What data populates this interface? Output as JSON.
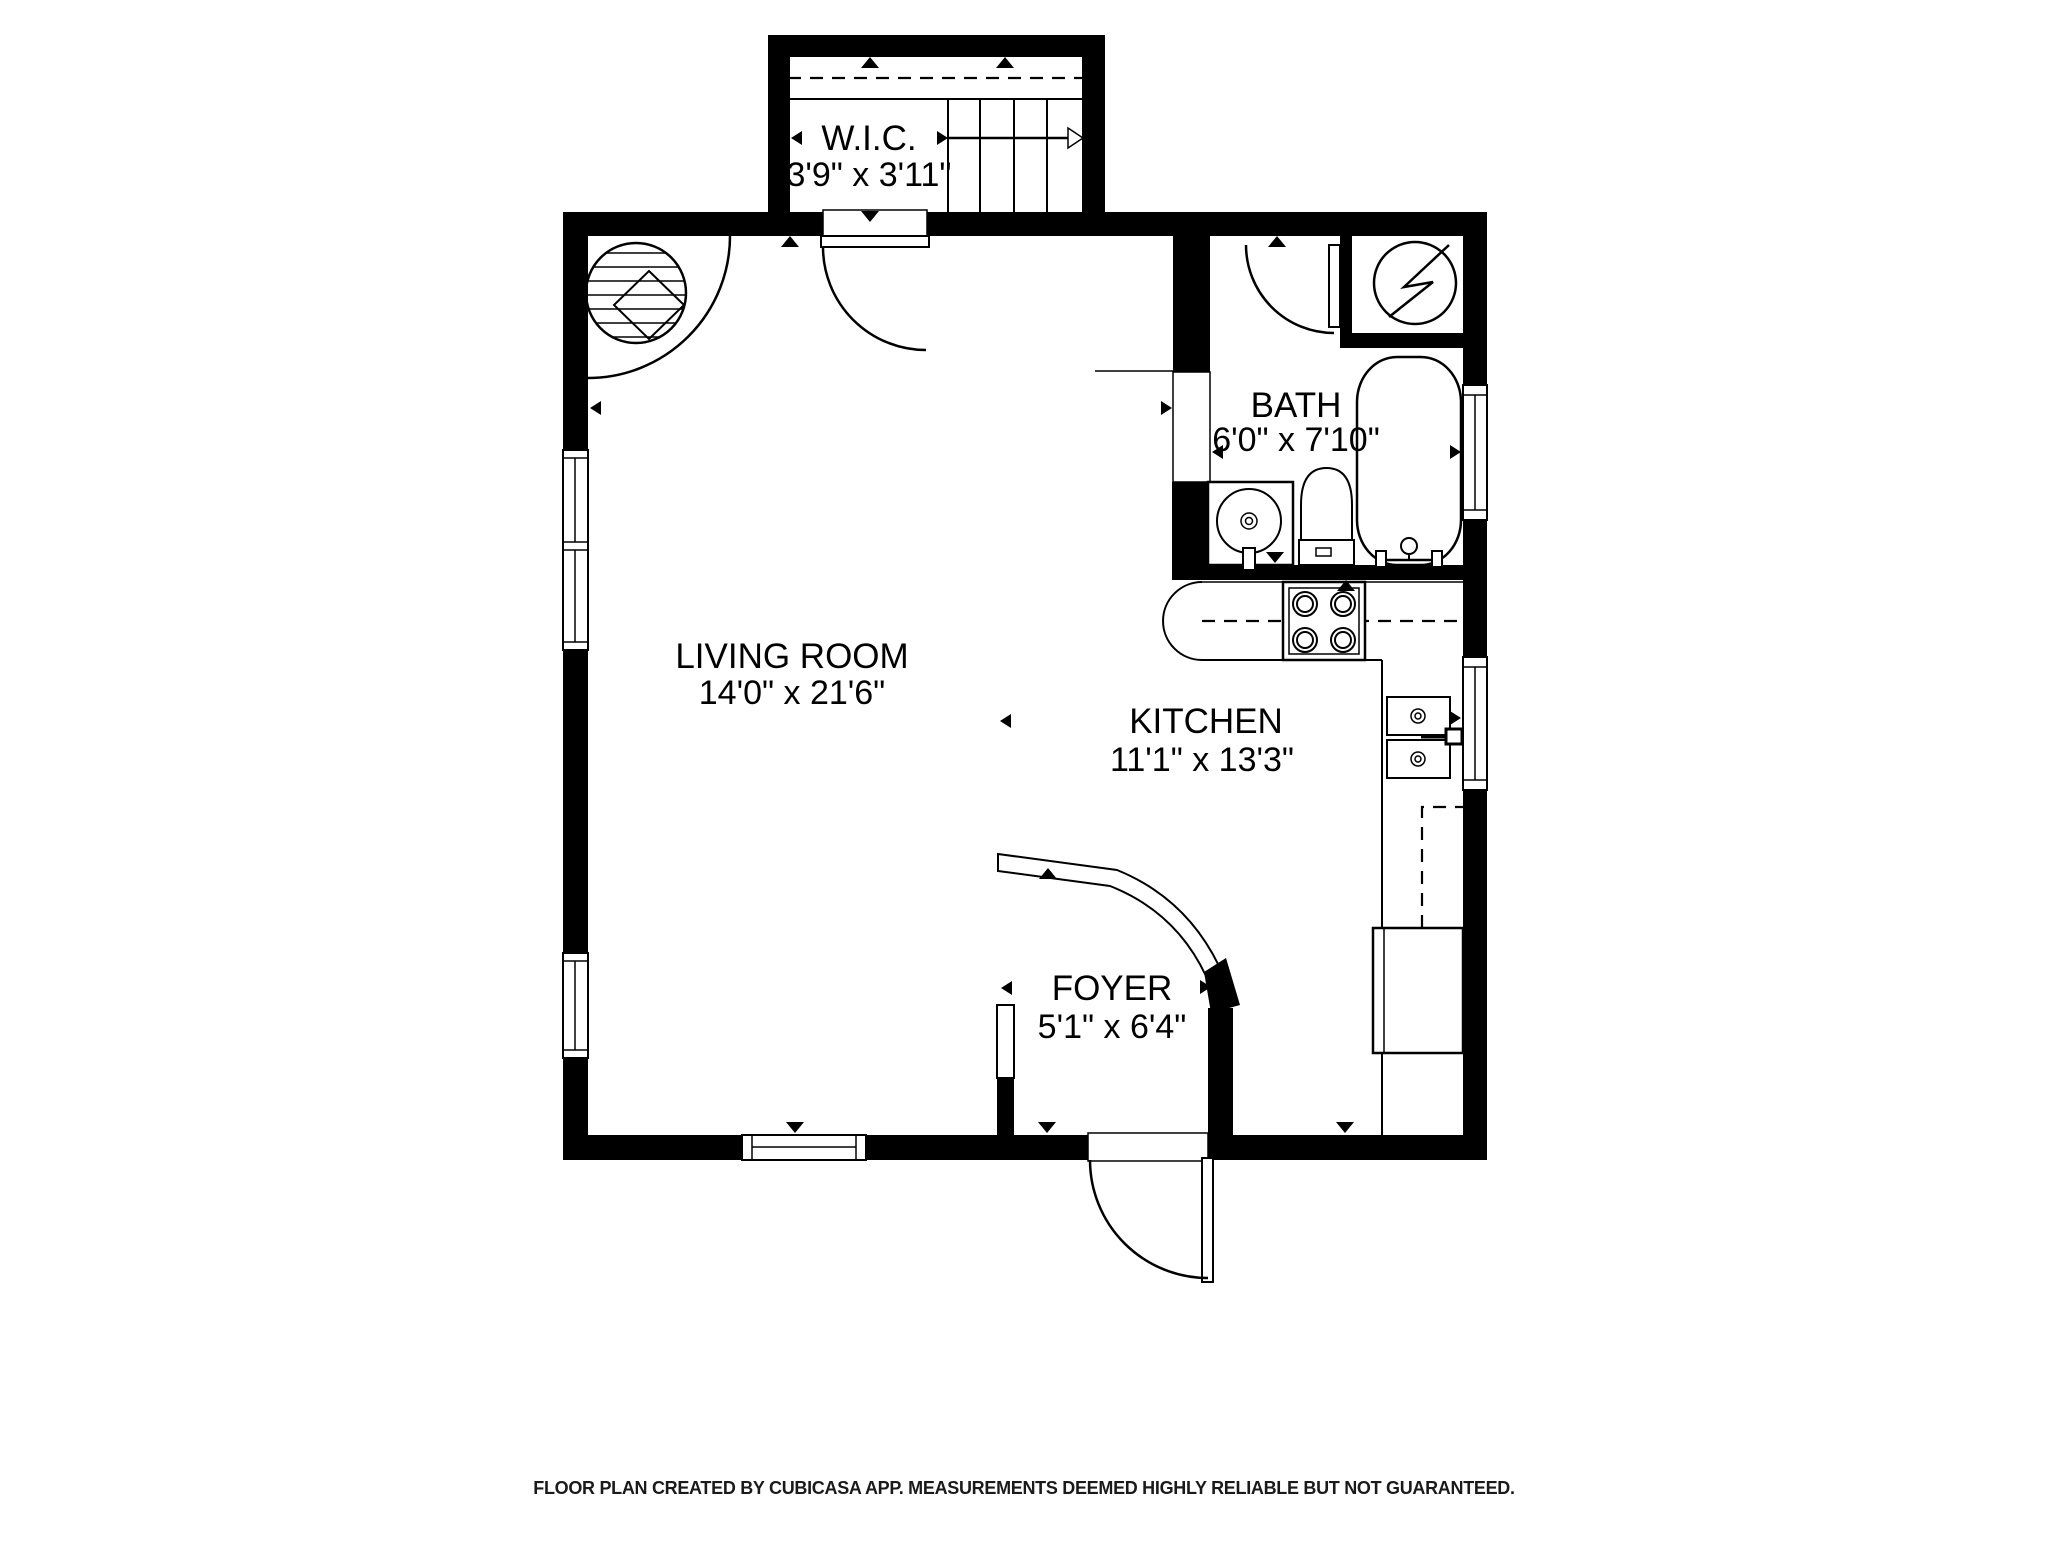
{
  "footer": {
    "text": "FLOOR PLAN CREATED BY CUBICASA APP. MEASUREMENTS DEEMED HIGHLY RELIABLE BUT NOT GUARANTEED."
  },
  "rooms": [
    {
      "id": "wic",
      "name": "W.I.C.",
      "dims": "3'9\" x 3'11\""
    },
    {
      "id": "bath",
      "name": "BATH",
      "dims": "6'0\" x 7'10\""
    },
    {
      "id": "living-room",
      "name": "LIVING ROOM",
      "dims": "14'0\" x 21'6\""
    },
    {
      "id": "kitchen",
      "name": "KITCHEN",
      "dims": "11'1\" x 13'3\""
    },
    {
      "id": "foyer",
      "name": "FOYER",
      "dims": "5'1\" x 6'4\""
    }
  ],
  "colors": {
    "wall": "#000000",
    "background": "#ffffff",
    "line": "#000000"
  }
}
